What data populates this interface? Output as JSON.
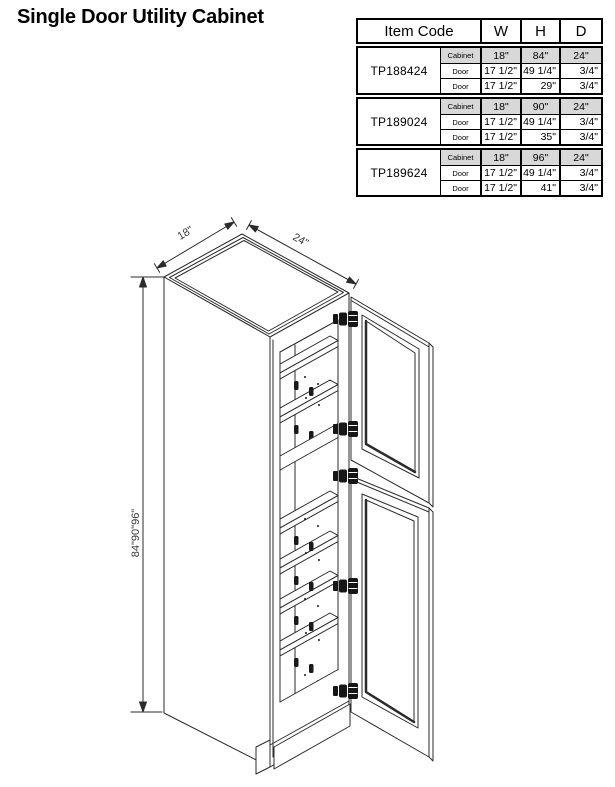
{
  "title": "Single Door Utility Cabinet",
  "drawing": {
    "dim_width": "18\"",
    "dim_depth": "24\"",
    "dim_height": "84\"90\"96\""
  },
  "table": {
    "header": {
      "item_code": "Item Code",
      "w": "W",
      "h": "H",
      "d": "D"
    },
    "groups": [
      {
        "code": "TP188424",
        "rows": [
          {
            "part": "Cabinet",
            "w": "18\"",
            "h": "84\"",
            "d": "24\""
          },
          {
            "part": "Door",
            "w": "17 1/2\"",
            "h": "49 1/4\"",
            "d": "3/4\""
          },
          {
            "part": "Door",
            "w": "17 1/2\"",
            "h": "29\"",
            "d": "3/4\""
          }
        ]
      },
      {
        "code": "TP189024",
        "rows": [
          {
            "part": "Cabinet",
            "w": "18\"",
            "h": "90\"",
            "d": "24\""
          },
          {
            "part": "Door",
            "w": "17 1/2\"",
            "h": "49 1/4\"",
            "d": "3/4\""
          },
          {
            "part": "Door",
            "w": "17 1/2\"",
            "h": "35\"",
            "d": "3/4\""
          }
        ]
      },
      {
        "code": "TP189624",
        "rows": [
          {
            "part": "Cabinet",
            "w": "18\"",
            "h": "96\"",
            "d": "24\""
          },
          {
            "part": "Door",
            "w": "17 1/2\"",
            "h": "49 1/4\"",
            "d": "3/4\""
          },
          {
            "part": "Door",
            "w": "17 1/2\"",
            "h": "41\"",
            "d": "3/4\""
          }
        ]
      }
    ]
  },
  "colors": {
    "line": "#2b2b2b",
    "table_border": "#000000",
    "row_shade": "#d8d8d8"
  }
}
